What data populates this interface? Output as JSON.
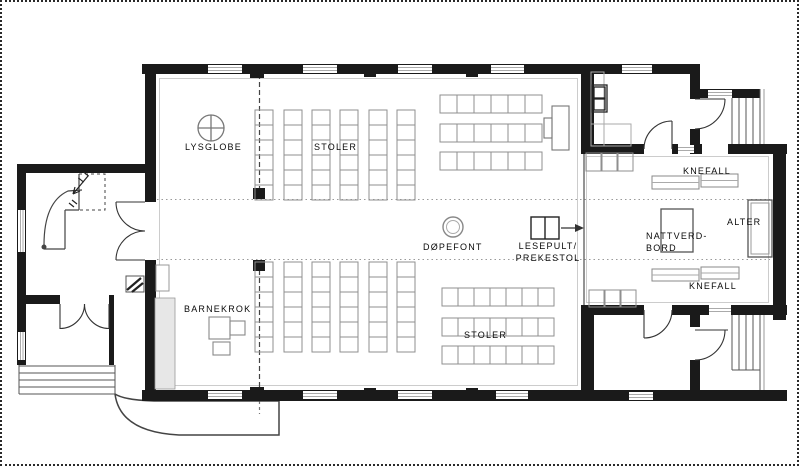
{
  "plan": {
    "labels": {
      "lysglobe": "LYSGLOBE",
      "stoler_top": "STOLER",
      "stoler_bottom": "STOLER",
      "barnekrok": "BARNEKROK",
      "dopefont": "DØPEFONT",
      "lesepult_line1": "LESEPULT/",
      "lesepult_line2": "PREKESTOL",
      "nattverd_line1": "NATTVERD-",
      "nattverd_line2": "BORD",
      "alter": "ALTER",
      "knefall_top": "KNEFALL",
      "knefall_bottom": "KNEFALL"
    },
    "colors": {
      "wall": "#1a1a1a",
      "line": "#555555",
      "furniture": "#8f8f8f",
      "guide": "#c9c9c9"
    }
  }
}
